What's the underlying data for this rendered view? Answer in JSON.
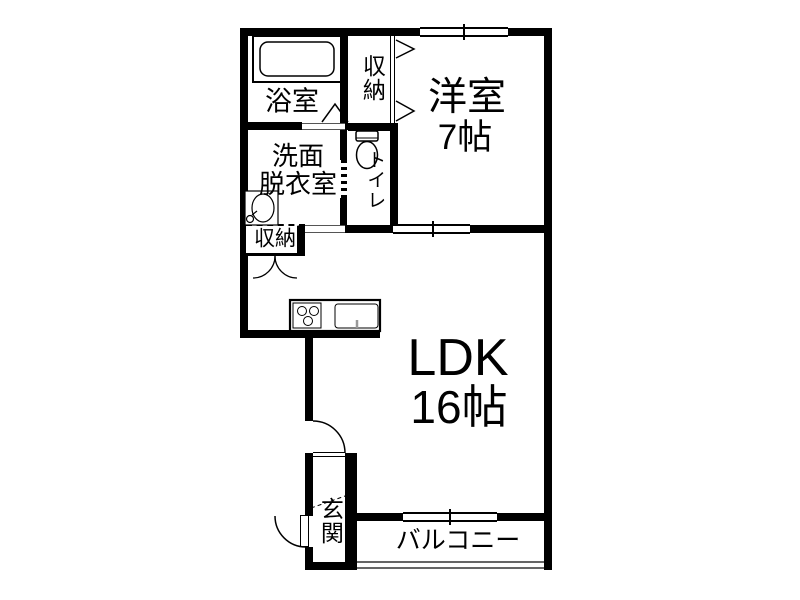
{
  "floorplan": {
    "rooms": {
      "bathroom": {
        "label": "浴室"
      },
      "closet_upper": {
        "label": "収納"
      },
      "western_room": {
        "label": "洋室",
        "size": "7帖"
      },
      "washroom": {
        "line1": "洗面",
        "line2": "脱衣室"
      },
      "toilet": {
        "label": "トイレ"
      },
      "closet_ldk": {
        "label": "収納"
      },
      "ldk": {
        "label": "LDK",
        "size": "16帖"
      },
      "entrance": {
        "label": "玄関"
      },
      "balcony": {
        "label": "バルコニー"
      }
    },
    "colors": {
      "wall": "#000000",
      "thin_line": "#555555",
      "background": "#ffffff"
    }
  }
}
